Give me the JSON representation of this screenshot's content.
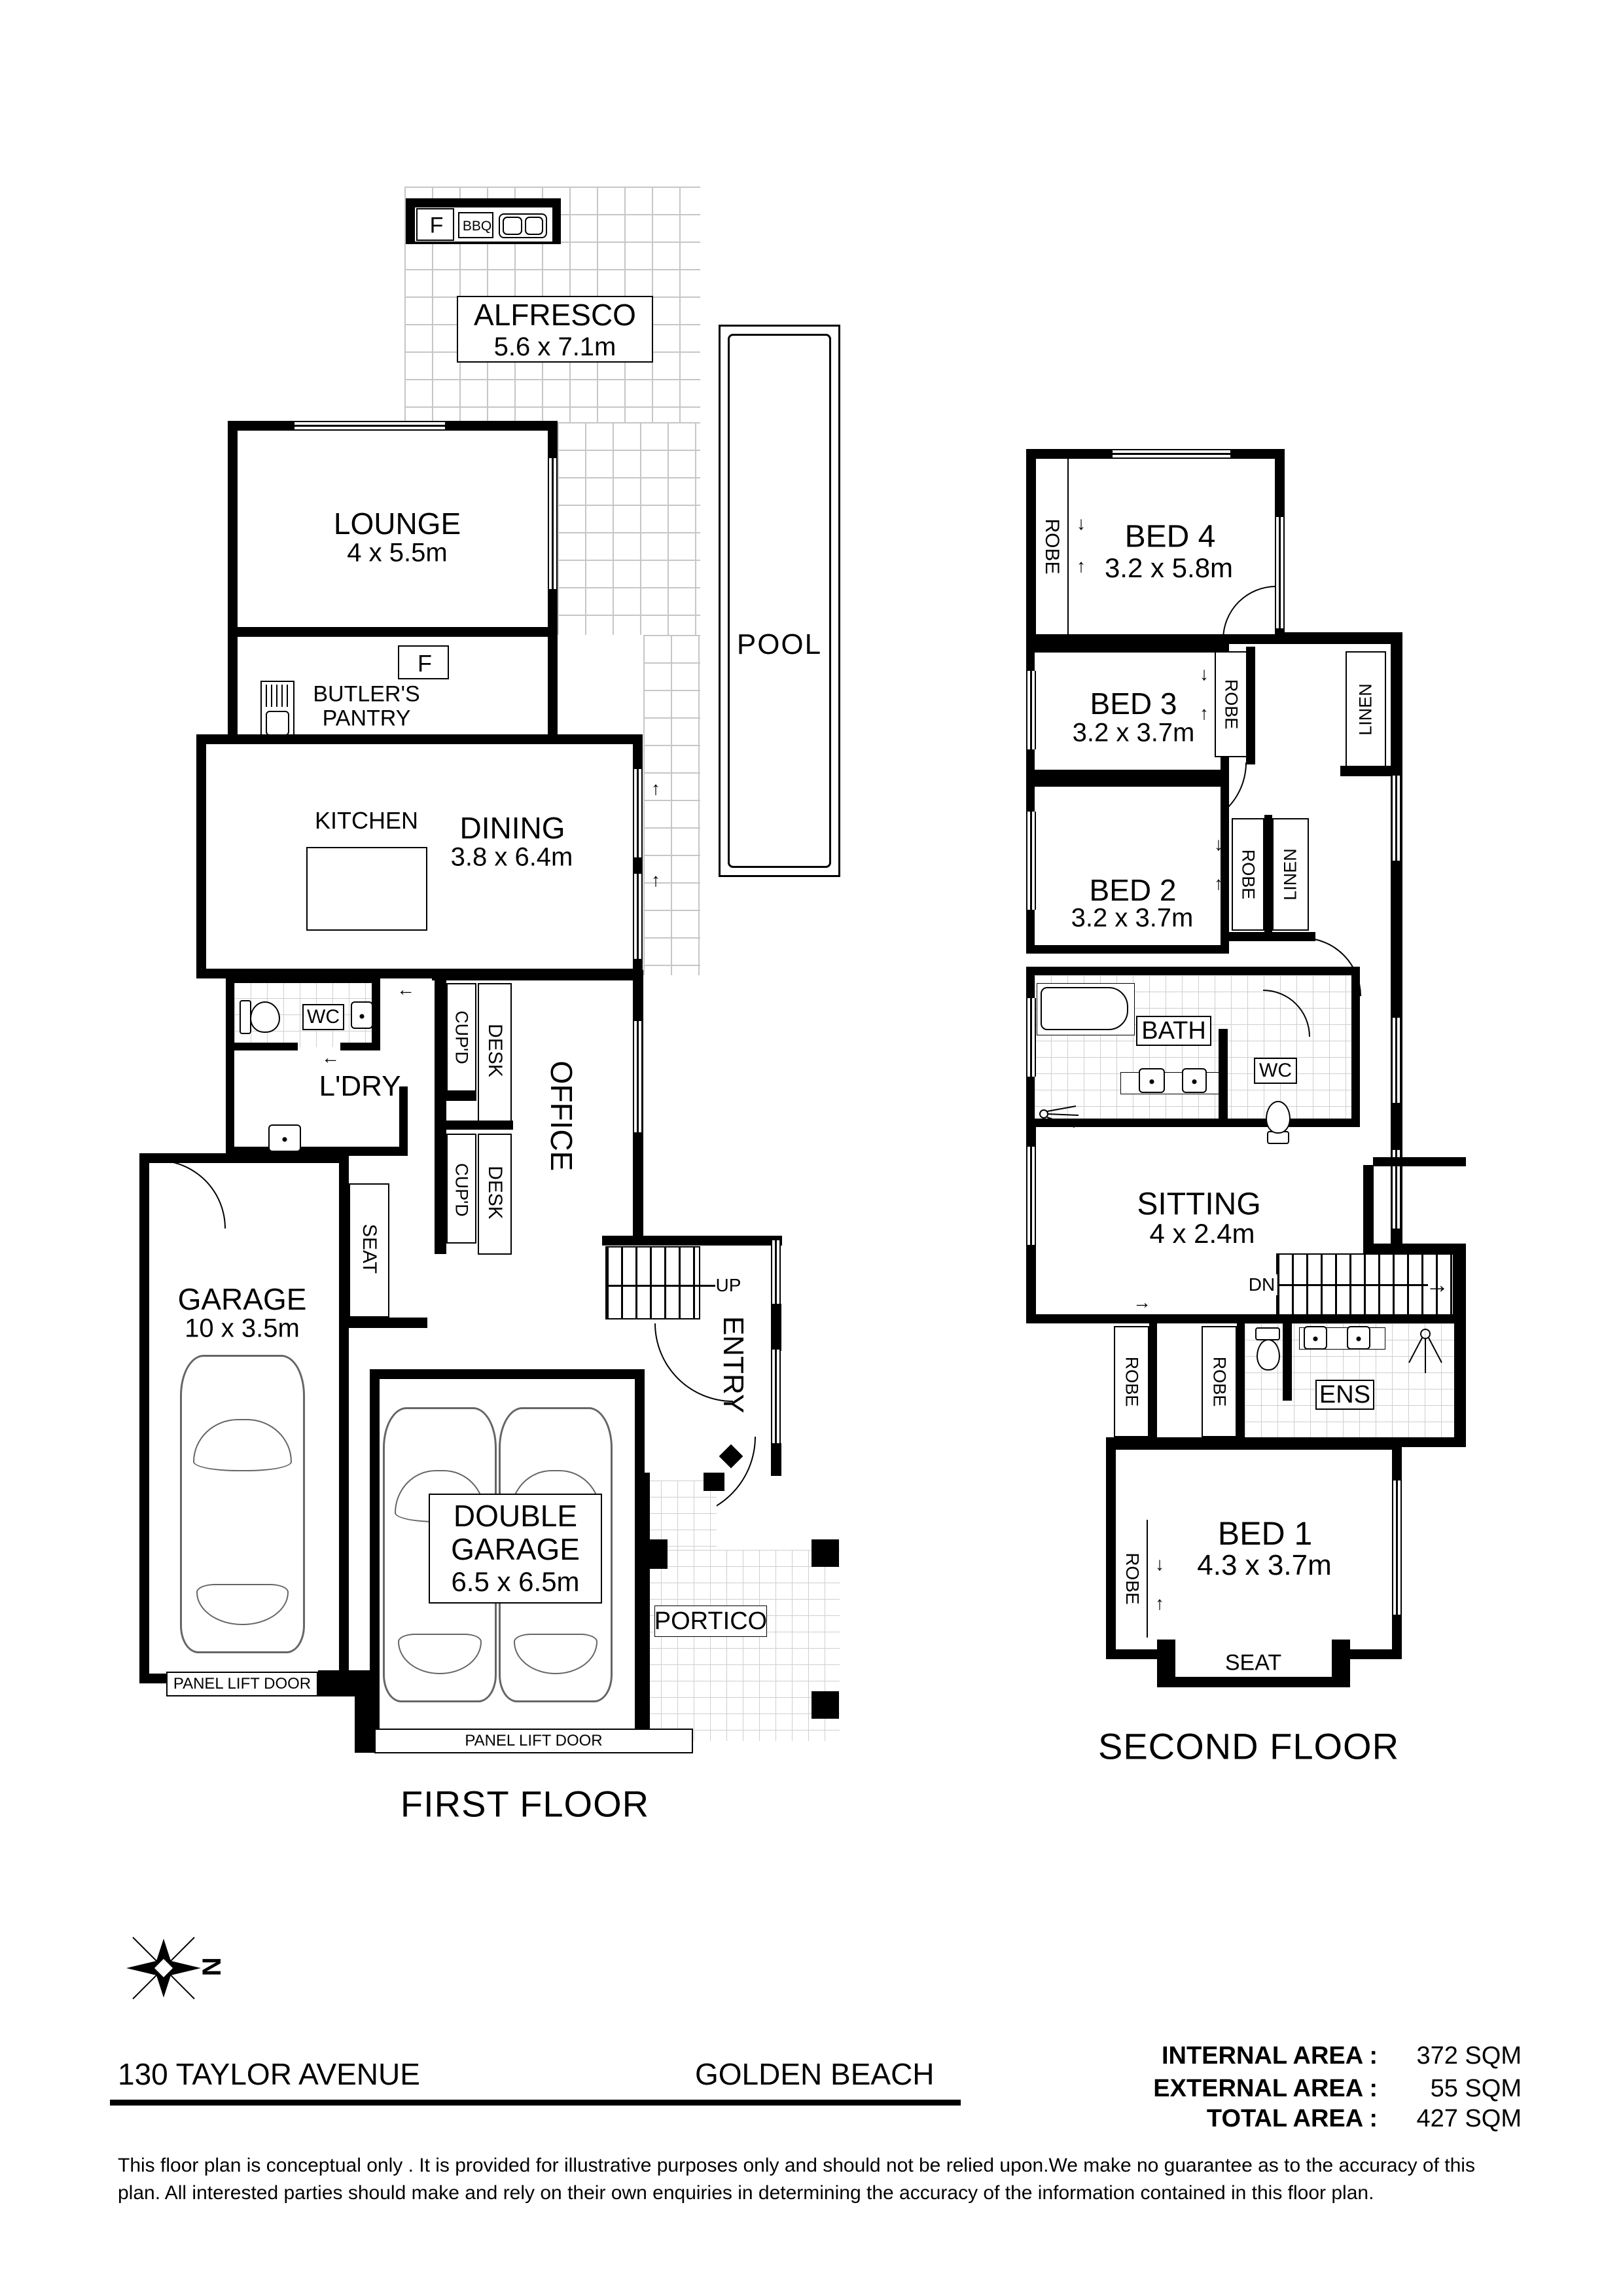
{
  "first_floor": {
    "title": "FIRST FLOOR",
    "alfresco": {
      "name": "ALFRESCO",
      "dims": "5.6 x 7.1m"
    },
    "bbq": {
      "f": "F",
      "label": "BBQ"
    },
    "pool": {
      "name": "POOL"
    },
    "lounge": {
      "name": "LOUNGE",
      "dims": "4 x 5.5m"
    },
    "butlers_pantry": {
      "name": "BUTLER'S PANTRY",
      "fridge_top": "F",
      "fridge_bottom": "F",
      "wall_oven": "WO"
    },
    "kitchen": {
      "name": "KITCHEN"
    },
    "dining": {
      "name": "DINING",
      "dims": "3.8 x 6.4m"
    },
    "wc": {
      "name": "WC"
    },
    "laundry": {
      "name": "L'DRY"
    },
    "office": {
      "name": "OFFICE",
      "cupboard": "CUP'D",
      "desk": "DESK"
    },
    "garage": {
      "name": "GARAGE",
      "dims": "10 x 3.5m",
      "seat": "SEAT"
    },
    "stairs": {
      "up": "UP"
    },
    "entry": {
      "name": "ENTRY"
    },
    "double_garage": {
      "name": "DOUBLE GARAGE",
      "dims": "6.5 x 6.5m"
    },
    "portico": {
      "name": "PORTICO"
    },
    "panel_lift_door": "PANEL LIFT DOOR"
  },
  "second_floor": {
    "title": "SECOND FLOOR",
    "bed4": {
      "name": "BED 4",
      "dims": "3.2 x 5.8m"
    },
    "bed3": {
      "name": "BED 3",
      "dims": "3.2 x 3.7m"
    },
    "bed2": {
      "name": "BED 2",
      "dims": "3.2 x 3.7m"
    },
    "bed1": {
      "name": "BED 1",
      "dims": "4.3 x 3.7m"
    },
    "bath": {
      "name": "BATH"
    },
    "wc": {
      "name": "WC"
    },
    "ens": {
      "name": "ENS"
    },
    "sitting": {
      "name": "SITTING",
      "dims": "4 x 2.4m"
    },
    "robe": "ROBE",
    "linen": "LINEN",
    "stairs": {
      "dn": "DN"
    },
    "seat": "SEAT"
  },
  "footer": {
    "compass": "N",
    "address": "130 TAYLOR AVENUE",
    "suburb": "GOLDEN BEACH",
    "areas": [
      {
        "label": "INTERNAL AREA :",
        "value": "372 SQM"
      },
      {
        "label": "EXTERNAL AREA :",
        "value": "55 SQM"
      },
      {
        "label": "TOTAL AREA :",
        "value": "427 SQM"
      }
    ],
    "disclaimer_line1": "This floor plan  is conceptual only . It is provided for illustrative purposes only and should not be relied upon.We make no guarantee as to the accuracy of this",
    "disclaimer_line2": "plan. All interested parties should make and rely on their own enquiries in determining the accuracy of the information contained in this floor plan."
  }
}
